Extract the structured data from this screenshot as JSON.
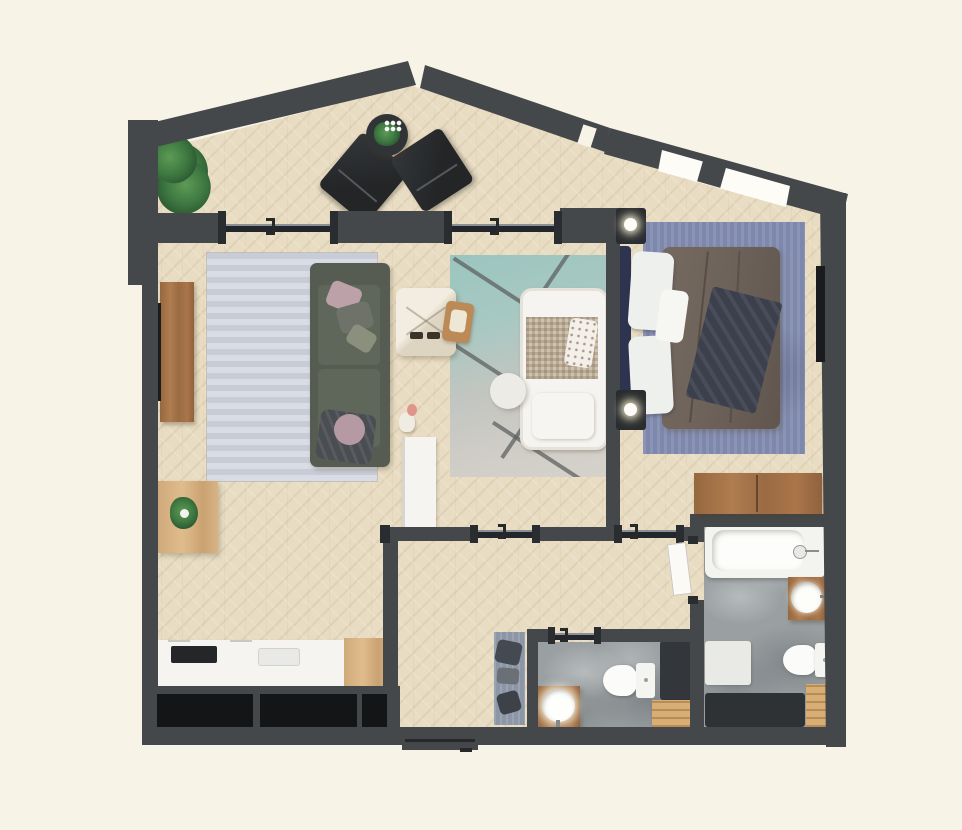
{
  "scene": {
    "title": "Two-bedroom apartment floor plan, top-down 3D render",
    "style": "photoreal top view, no text labels",
    "background": "#f8f3e7"
  },
  "palette": {
    "background": "#f8f3e7",
    "wall": "#45484b",
    "wall_dark": "#2a2d2f",
    "window_black": "#141516",
    "wood_floor": "#e8dcc2",
    "concrete_floor": "#9aa0a2",
    "rug_living": "#ced2dc",
    "rug_bedroom": "#7e88ac",
    "rug_kids_teal": "#9cc5bf",
    "rug_kids_gray": "#d0cdc7",
    "runner_rug": "#8c96a6",
    "sofa_green": "#565c52",
    "bed_frame_navy": "#2c3450",
    "duvet_brown": "#6e635a",
    "walnut_wood": "#a1714a",
    "oak_wood": "#d6b285",
    "chair_green": "#6d7a36",
    "white_fixtures": "#f5f4f1",
    "plant_green": "#3f7a42"
  },
  "rooms": {
    "balcony": {
      "name": "balcony terrace",
      "furniture": [
        "large potted plant",
        "two dark lounge chairs",
        "round side table with flowers"
      ]
    },
    "living_room": {
      "name": "living room",
      "furniture": [
        "light gray area rug",
        "green sofa with pillows and throw",
        "round black side table",
        "walnut media console",
        "wall TV",
        "small decor figurine"
      ]
    },
    "dining_area": {
      "name": "dining area",
      "furniture": [
        "oak dining table",
        "three green chairs",
        "table plant"
      ]
    },
    "kitchen": {
      "name": "kitchen",
      "furniture": [
        "white counter",
        "black cooktop",
        "sink",
        "oak end cabinet",
        "three black windows"
      ]
    },
    "kids_room": {
      "name": "kids area",
      "furniture": [
        "teal-gray geometric rug",
        "white bed with knit blanket and polka-dot pillow",
        "round pouf",
        "play teepee",
        "wooden high chair",
        "white wardrobe"
      ]
    },
    "bedroom": {
      "name": "master bedroom",
      "furniture": [
        "double bed with brown duvet and navy throw",
        "navy headboard",
        "two black nightstands with lamps",
        "blue rug",
        "wall TV",
        "sloped wall window"
      ]
    },
    "hallway": {
      "name": "entry hallway",
      "furniture": [
        "blue-gray runner rug with garments",
        "entry door"
      ]
    },
    "bathroom": {
      "name": "main bathroom",
      "furniture": [
        "bathtub",
        "round sink on walnut vanity",
        "toilet",
        "dark shower tray",
        "wooden duckboard",
        "walnut wall cabinet",
        "white bath mat",
        "swing door"
      ]
    },
    "wc": {
      "name": "small shower room",
      "furniture": [
        "round sink on walnut vanity",
        "toilet",
        "dark shower",
        "wooden duckboard",
        "sliding door"
      ]
    }
  },
  "doors": {
    "balcony_living_slider": "sliding glass door",
    "balcony_kids_slider": "sliding glass door",
    "kids_room_slider": "sliding glass door to hallway",
    "bedroom_lobby_slider": "sliding glass door",
    "wc_slider": "sliding door",
    "bathroom_door": "swing door",
    "entry_door": "apartment entry door at bottom wall"
  }
}
